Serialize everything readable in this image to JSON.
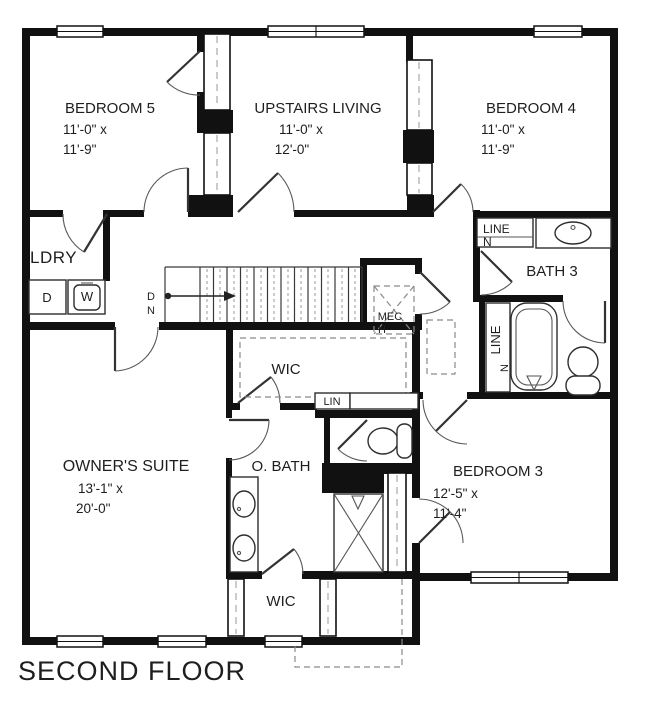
{
  "title": "SECOND FLOOR",
  "colors": {
    "wall": "#111111",
    "line": "#2e2e2e",
    "dashed": "#8a8a8a",
    "background": "#ffffff",
    "text": "#1e1e1e"
  },
  "rooms": {
    "bedroom5": {
      "name": "BEDROOM 5",
      "dim1": "11'-0\" x",
      "dim2": "11'-9\""
    },
    "upstairs_living": {
      "name": "UPSTAIRS LIVING",
      "dim1": "11'-0\" x",
      "dim2": "12'-0\""
    },
    "bedroom4": {
      "name": "BEDROOM 4",
      "dim1": "11'-0\" x",
      "dim2": "11'-9\""
    },
    "bedroom3": {
      "name": "BEDROOM 3",
      "dim1": "12'-5\" x",
      "dim2": "11'-4\""
    },
    "owners_suite": {
      "name": "OWNER'S SUITE",
      "dim1": "13'-1\" x",
      "dim2": "20'-0\""
    },
    "owners_bath": {
      "name": "O. BATH"
    },
    "bath3": {
      "name": "BATH 3"
    },
    "laundry": {
      "name": "LDRY"
    },
    "wic_hall": {
      "name": "WIC"
    },
    "wic_owners": {
      "name": "WIC"
    },
    "linen_upper": {
      "line1": "LINE",
      "line2": "N"
    },
    "linen_lower": {
      "line1": "LINE",
      "line2": "N"
    },
    "linen_small": {
      "name": "LIN"
    },
    "mechanical": {
      "line1": "MEC",
      "line2": "H"
    }
  },
  "fixtures": {
    "dryer": "D",
    "washer": "W"
  },
  "stairs": {
    "direction1": "D",
    "direction2": "N"
  }
}
